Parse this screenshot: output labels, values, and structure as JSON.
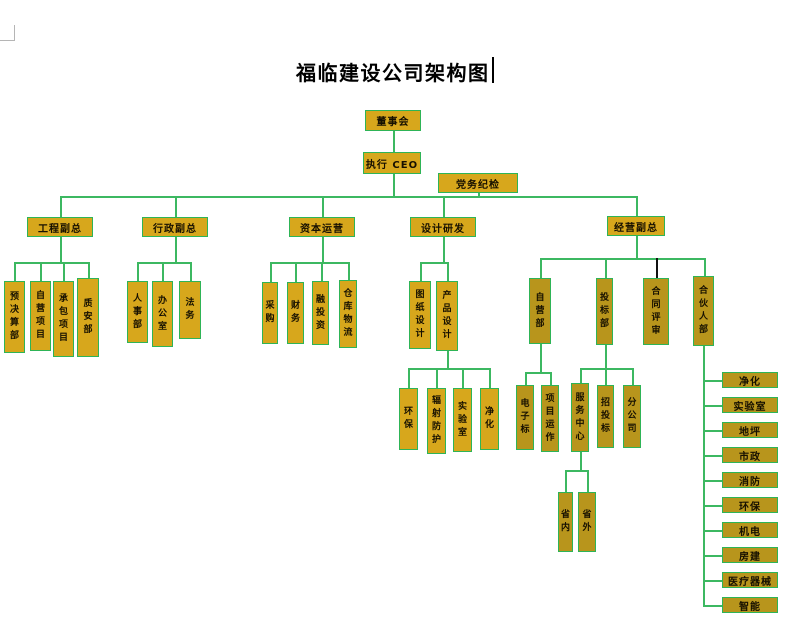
{
  "page": {
    "title": "福临建设公司架构图"
  },
  "colors": {
    "title_color": "#000000",
    "box_fill": "#d7a71c",
    "box_fill_dark": "#b8951c",
    "box_border": "#2eb457",
    "box_text": "#161000",
    "line_green": "#3cb861",
    "line_black": "#111111"
  },
  "diagram": {
    "nodes": [
      {
        "id": "board",
        "label": "董事会",
        "x": 365,
        "y": 110,
        "w": 56,
        "h": 21
      },
      {
        "id": "ceo",
        "label": "执行 CEO",
        "x": 363,
        "y": 152,
        "w": 58,
        "h": 22
      },
      {
        "id": "party-discipline",
        "label": "党务纪检",
        "x": 438,
        "y": 173,
        "w": 80,
        "h": 20
      },
      {
        "id": "eng-vp",
        "label": "工程副总",
        "x": 27,
        "y": 217,
        "w": 66,
        "h": 20
      },
      {
        "id": "admin-vp",
        "label": "行政副总",
        "x": 142,
        "y": 217,
        "w": 66,
        "h": 20
      },
      {
        "id": "capital-ops",
        "label": "资本运营",
        "x": 289,
        "y": 217,
        "w": 66,
        "h": 20
      },
      {
        "id": "design-rd",
        "label": "设计研发",
        "x": 410,
        "y": 217,
        "w": 66,
        "h": 20
      },
      {
        "id": "biz-vp",
        "label": "经营副总",
        "x": 607,
        "y": 216,
        "w": 58,
        "h": 20
      },
      {
        "id": "budget-dept",
        "label": "预决算部",
        "x": 4,
        "y": 281,
        "w": 21,
        "h": 72,
        "vert": true
      },
      {
        "id": "self-projects",
        "label": "自营项目",
        "x": 30,
        "y": 281,
        "w": 21,
        "h": 70,
        "vert": true
      },
      {
        "id": "contract-projects",
        "label": "承包项目",
        "x": 53,
        "y": 281,
        "w": 21,
        "h": 76,
        "vert": true
      },
      {
        "id": "quality-safety",
        "label": "质安部",
        "x": 77,
        "y": 278,
        "w": 22,
        "h": 79,
        "vert": true
      },
      {
        "id": "hr-dept",
        "label": "人事部",
        "x": 127,
        "y": 281,
        "w": 21,
        "h": 62,
        "vert": true
      },
      {
        "id": "office",
        "label": "办公室",
        "x": 152,
        "y": 281,
        "w": 21,
        "h": 66,
        "vert": true
      },
      {
        "id": "legal",
        "label": "法务",
        "x": 179,
        "y": 281,
        "w": 22,
        "h": 58,
        "vert": true
      },
      {
        "id": "procurement",
        "label": "采购",
        "x": 262,
        "y": 282,
        "w": 16,
        "h": 62,
        "vert": true
      },
      {
        "id": "finance",
        "label": "财务",
        "x": 287,
        "y": 282,
        "w": 17,
        "h": 62,
        "vert": true
      },
      {
        "id": "investment",
        "label": "融投资",
        "x": 312,
        "y": 281,
        "w": 17,
        "h": 64,
        "vert": true
      },
      {
        "id": "warehouse-logistics",
        "label": "仓库物流",
        "x": 339,
        "y": 280,
        "w": 18,
        "h": 68,
        "vert": true
      },
      {
        "id": "drawing-design",
        "label": "图纸设计",
        "x": 409,
        "y": 281,
        "w": 22,
        "h": 68,
        "vert": true
      },
      {
        "id": "product-design",
        "label": "产品设计",
        "x": 436,
        "y": 281,
        "w": 22,
        "h": 70,
        "vert": true
      },
      {
        "id": "env-protection-design",
        "label": "环保",
        "x": 399,
        "y": 388,
        "w": 19,
        "h": 62,
        "vert": true
      },
      {
        "id": "radiation-protection",
        "label": "辐射防护",
        "x": 427,
        "y": 388,
        "w": 19,
        "h": 66,
        "vert": true
      },
      {
        "id": "laboratory-design",
        "label": "实验室",
        "x": 453,
        "y": 388,
        "w": 19,
        "h": 64,
        "vert": true
      },
      {
        "id": "purification-design",
        "label": "净化",
        "x": 480,
        "y": 388,
        "w": 19,
        "h": 62,
        "vert": true
      },
      {
        "id": "self-dept",
        "label": "自营部",
        "x": 529,
        "y": 278,
        "w": 22,
        "h": 66,
        "vert": true,
        "dark": true
      },
      {
        "id": "bidding-dept",
        "label": "投标部",
        "x": 596,
        "y": 278,
        "w": 17,
        "h": 67,
        "vert": true,
        "dark": true
      },
      {
        "id": "contract-review",
        "label": "合同评审",
        "x": 643,
        "y": 278,
        "w": 26,
        "h": 67,
        "vert": true,
        "dark": true
      },
      {
        "id": "partner-dept",
        "label": "合伙人部",
        "x": 693,
        "y": 276,
        "w": 21,
        "h": 70,
        "vert": true,
        "dark": true
      },
      {
        "id": "e-bidding",
        "label": "电子标",
        "x": 516,
        "y": 385,
        "w": 18,
        "h": 65,
        "vert": true,
        "dark": true
      },
      {
        "id": "project-operation",
        "label": "项目运作",
        "x": 541,
        "y": 385,
        "w": 18,
        "h": 67,
        "vert": true,
        "dark": true
      },
      {
        "id": "service-center",
        "label": "服务中心",
        "x": 571,
        "y": 383,
        "w": 18,
        "h": 69,
        "vert": true,
        "dark": true
      },
      {
        "id": "tendering",
        "label": "招投标",
        "x": 597,
        "y": 385,
        "w": 17,
        "h": 63,
        "vert": true,
        "dark": true
      },
      {
        "id": "branch-company",
        "label": "分公司",
        "x": 623,
        "y": 385,
        "w": 18,
        "h": 63,
        "vert": true,
        "dark": true
      },
      {
        "id": "in-province",
        "label": "省内",
        "x": 558,
        "y": 492,
        "w": 15,
        "h": 60,
        "vert": true,
        "dark": true
      },
      {
        "id": "out-province",
        "label": "省外",
        "x": 578,
        "y": 492,
        "w": 18,
        "h": 60,
        "vert": true,
        "dark": true
      },
      {
        "id": "partner-purification",
        "label": "净化",
        "x": 722,
        "y": 372,
        "w": 56,
        "h": 16,
        "dark": true
      },
      {
        "id": "partner-laboratory",
        "label": "实验室",
        "x": 722,
        "y": 397,
        "w": 56,
        "h": 16,
        "dark": true
      },
      {
        "id": "partner-flooring",
        "label": "地坪",
        "x": 722,
        "y": 422,
        "w": 56,
        "h": 16,
        "dark": true
      },
      {
        "id": "partner-municipal",
        "label": "市政",
        "x": 722,
        "y": 447,
        "w": 56,
        "h": 16,
        "dark": true
      },
      {
        "id": "partner-fire",
        "label": "消防",
        "x": 722,
        "y": 472,
        "w": 56,
        "h": 16,
        "dark": true
      },
      {
        "id": "partner-env",
        "label": "环保",
        "x": 722,
        "y": 497,
        "w": 56,
        "h": 16,
        "dark": true
      },
      {
        "id": "partner-mech-elec",
        "label": "机电",
        "x": 722,
        "y": 522,
        "w": 56,
        "h": 16,
        "dark": true
      },
      {
        "id": "partner-building",
        "label": "房建",
        "x": 722,
        "y": 547,
        "w": 56,
        "h": 16,
        "dark": true
      },
      {
        "id": "partner-medical",
        "label": "医疗器械",
        "x": 722,
        "y": 572,
        "w": 56,
        "h": 16,
        "dark": true
      },
      {
        "id": "partner-smart",
        "label": "智能",
        "x": 722,
        "y": 597,
        "w": 56,
        "h": 16,
        "dark": true
      }
    ],
    "connectors": [
      [
        393,
        131,
        393,
        152
      ],
      [
        393,
        174,
        393,
        196
      ],
      [
        60,
        196,
        636,
        196
      ],
      [
        478,
        193,
        478,
        196
      ],
      [
        60,
        196,
        60,
        217
      ],
      [
        175,
        196,
        175,
        217
      ],
      [
        322,
        196,
        322,
        217
      ],
      [
        443,
        196,
        443,
        217
      ],
      [
        636,
        196,
        636,
        216
      ],
      [
        60,
        237,
        60,
        262
      ],
      [
        14,
        262,
        88,
        262
      ],
      [
        14,
        262,
        14,
        281
      ],
      [
        40,
        262,
        40,
        281
      ],
      [
        63,
        262,
        63,
        281
      ],
      [
        88,
        262,
        88,
        278
      ],
      [
        175,
        237,
        175,
        262
      ],
      [
        137,
        262,
        190,
        262
      ],
      [
        137,
        262,
        137,
        281
      ],
      [
        162,
        262,
        162,
        281
      ],
      [
        190,
        262,
        190,
        281
      ],
      [
        322,
        237,
        322,
        262
      ],
      [
        270,
        262,
        348,
        262
      ],
      [
        270,
        262,
        270,
        282
      ],
      [
        295,
        262,
        295,
        282
      ],
      [
        321,
        262,
        321,
        281
      ],
      [
        348,
        262,
        348,
        280
      ],
      [
        443,
        237,
        443,
        262
      ],
      [
        420,
        262,
        447,
        262
      ],
      [
        420,
        262,
        420,
        281
      ],
      [
        447,
        262,
        447,
        281
      ],
      [
        447,
        351,
        447,
        368
      ],
      [
        408,
        368,
        489,
        368
      ],
      [
        408,
        368,
        408,
        388
      ],
      [
        436,
        368,
        436,
        388
      ],
      [
        462,
        368,
        462,
        388
      ],
      [
        489,
        368,
        489,
        388
      ],
      [
        636,
        236,
        636,
        258
      ],
      [
        540,
        258,
        704,
        258
      ],
      [
        540,
        258,
        540,
        278
      ],
      [
        605,
        258,
        605,
        278
      ],
      [
        656,
        258,
        656,
        278,
        "k"
      ],
      [
        704,
        258,
        704,
        276
      ],
      [
        540,
        344,
        540,
        372
      ],
      [
        525,
        372,
        550,
        372
      ],
      [
        525,
        372,
        525,
        385
      ],
      [
        550,
        372,
        550,
        385
      ],
      [
        605,
        345,
        605,
        368
      ],
      [
        580,
        368,
        632,
        368
      ],
      [
        580,
        368,
        580,
        383
      ],
      [
        605,
        368,
        605,
        385
      ],
      [
        632,
        368,
        632,
        385
      ],
      [
        580,
        452,
        580,
        470
      ],
      [
        565,
        470,
        587,
        470
      ],
      [
        565,
        470,
        565,
        492
      ],
      [
        587,
        470,
        587,
        492
      ],
      [
        703,
        346,
        703,
        605
      ],
      [
        703,
        380,
        722,
        380
      ],
      [
        703,
        405,
        722,
        405
      ],
      [
        703,
        430,
        722,
        430
      ],
      [
        703,
        455,
        722,
        455
      ],
      [
        703,
        480,
        722,
        480
      ],
      [
        703,
        505,
        722,
        505
      ],
      [
        703,
        530,
        722,
        530
      ],
      [
        703,
        555,
        722,
        555
      ],
      [
        703,
        580,
        722,
        580
      ],
      [
        703,
        605,
        722,
        605
      ]
    ]
  }
}
